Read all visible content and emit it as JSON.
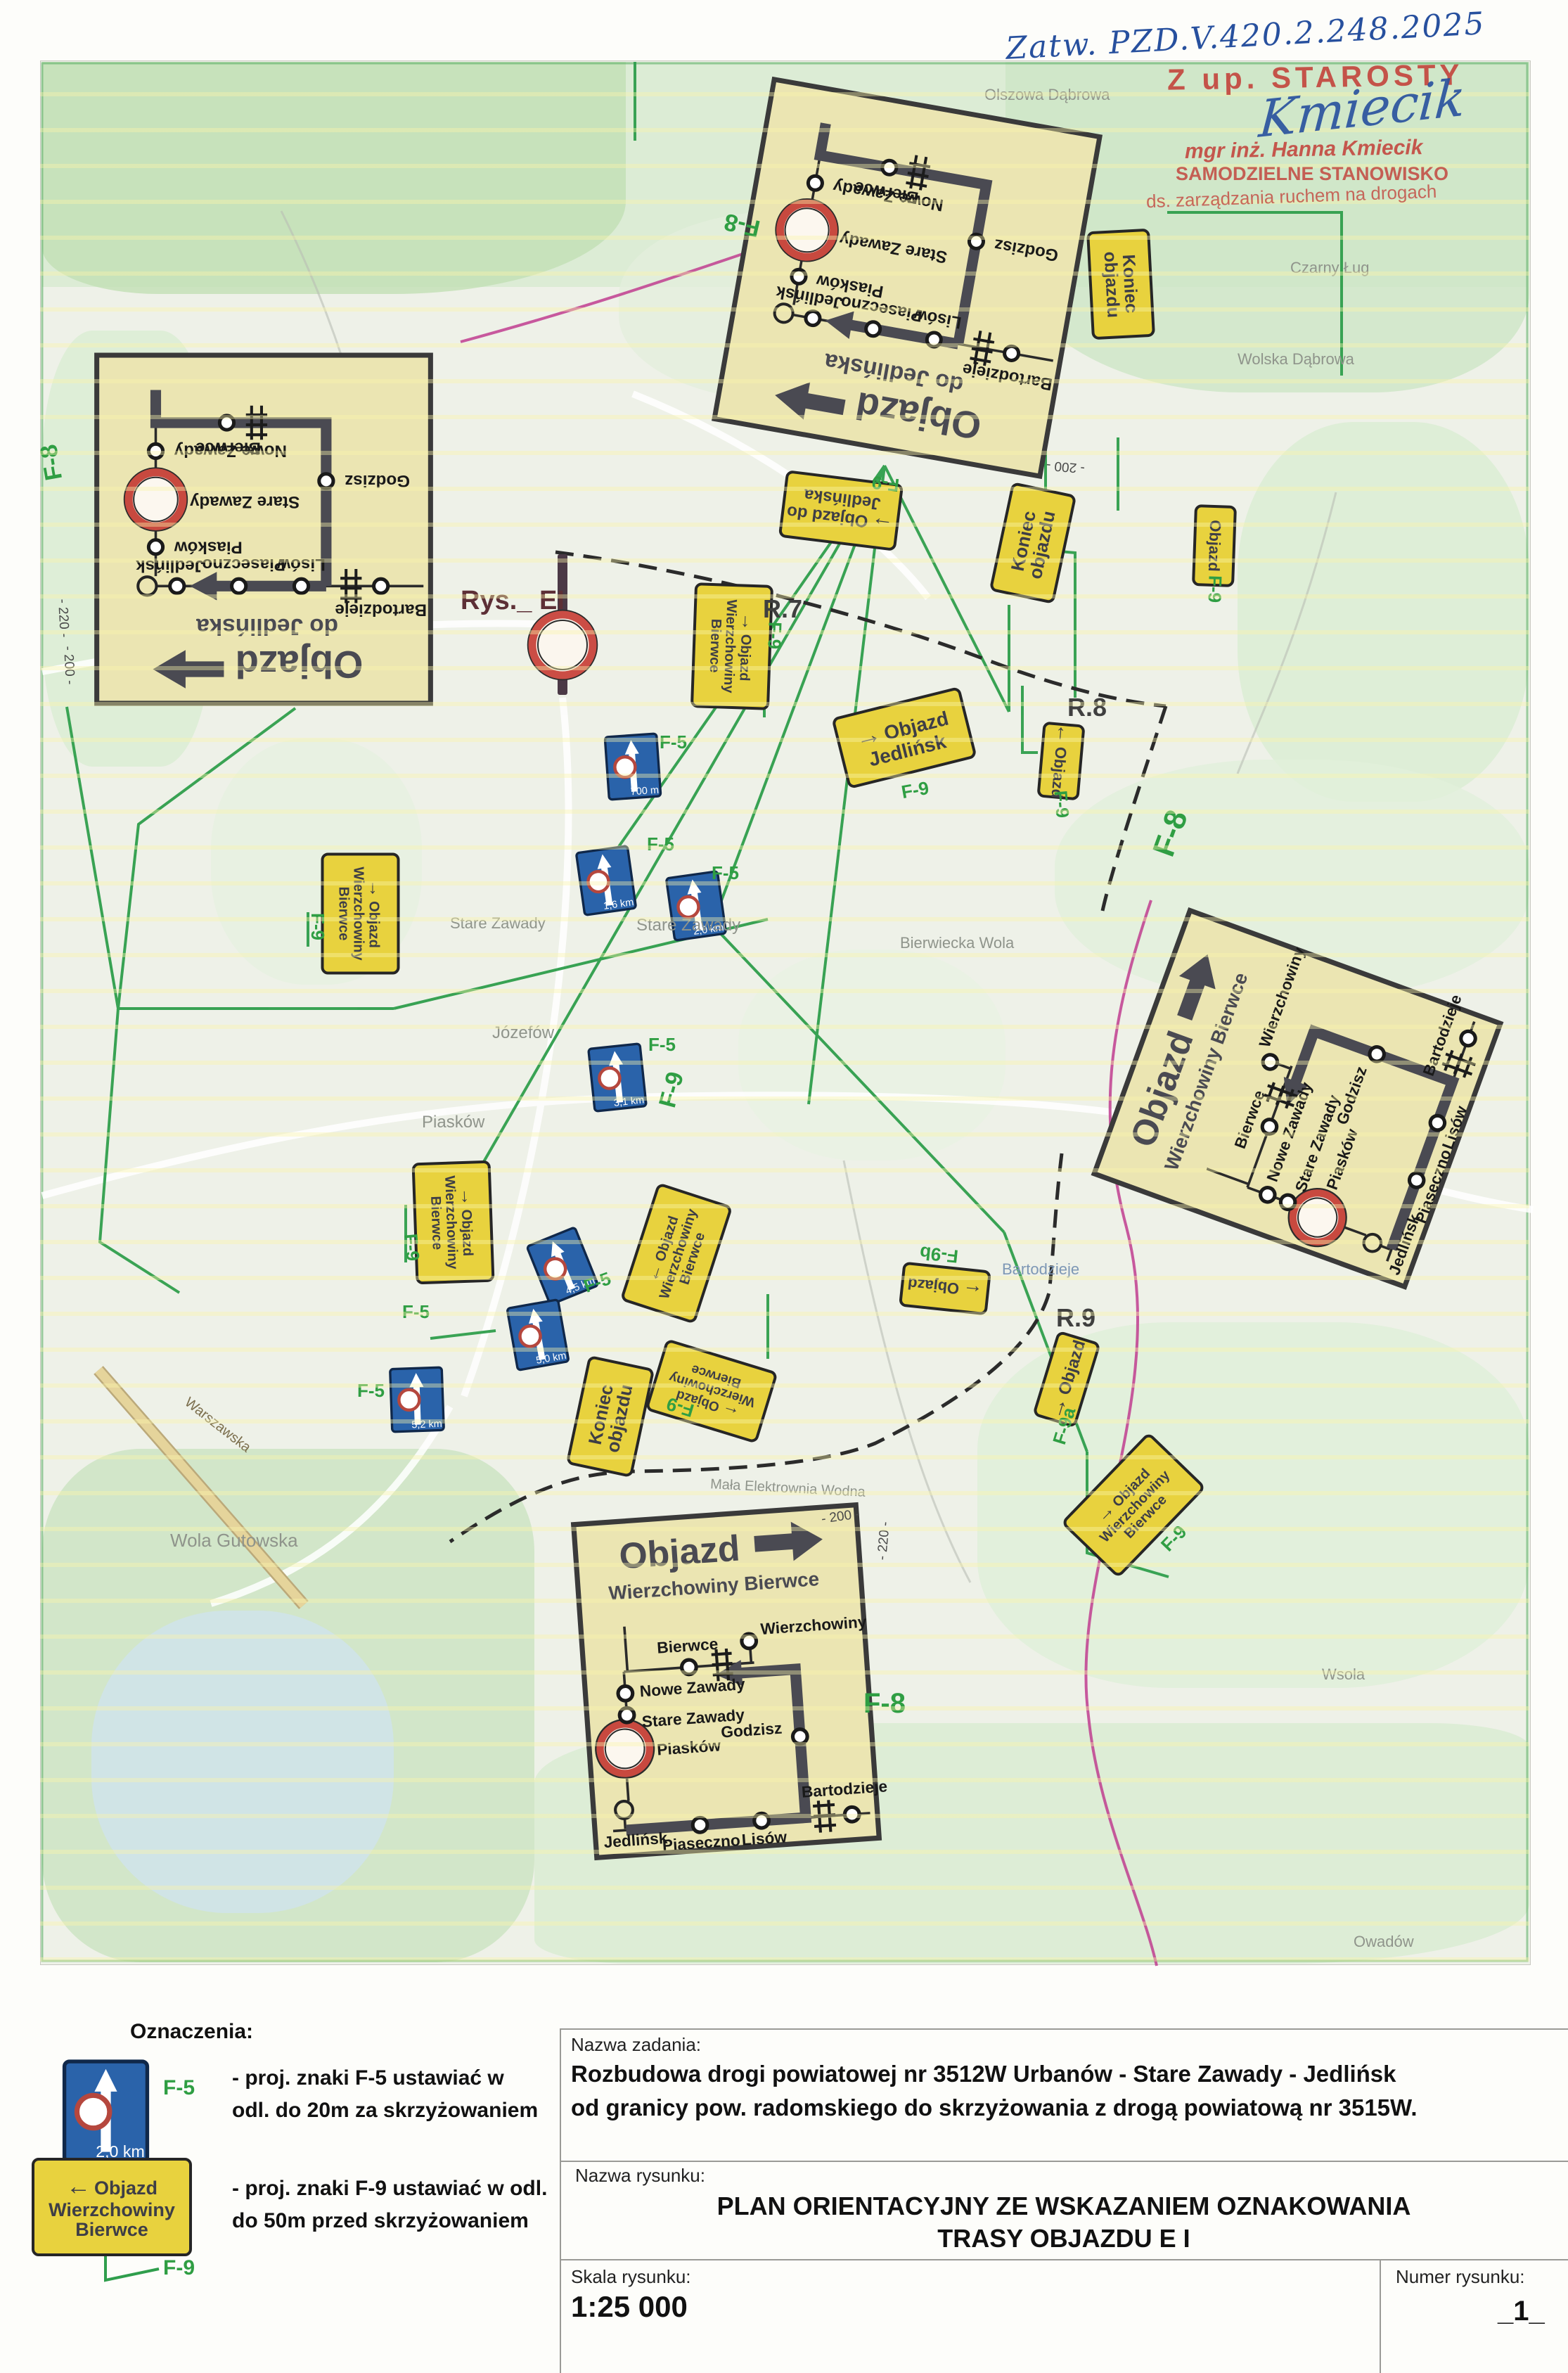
{
  "approval": {
    "handwritten_ref": "Zatw. PZD.V.420.2.248.2025",
    "stamp_title": "Z up. STAROSTY",
    "signature": "Kmiecik",
    "stamp_name": "mgr inż. Hanna Kmiecik",
    "stamp_role1": "SAMODZIELNE STANOWISKO",
    "stamp_role2": "ds. zarządzania ruchem na drogach"
  },
  "map": {
    "figure_label": "Rys._ EI",
    "refs": [
      "R.7",
      "R.8",
      "R.9"
    ],
    "green_labels": [
      "F-8",
      "F-8",
      "F-8",
      "F-8",
      "F-9"
    ],
    "contours": [
      "- 220 -",
      "- 200 -",
      "- 200 -",
      "- 220 -",
      "- 200 -"
    ],
    "places": [
      "Olszowa Dąbrowa",
      "Wolska Dąbrowa",
      "Czarny Ług",
      "Stare Zawady",
      "Stare Zawady",
      "Józefów",
      "Piasków",
      "Bierwiecka Wola",
      "Wola Gutowska",
      "Bartodzieje",
      "Mała Elektrownia Wodna",
      "Wsola",
      "Owadów",
      "Warszawska"
    ]
  },
  "insets": {
    "jedlinska": {
      "title": "Objazd",
      "subtitle": "do Jedlińska",
      "nodes": {
        "bierwce": "Bierwce",
        "nowe_zawady": "Nowe Zawady",
        "stare_zawady": "Stare Zawady",
        "godzisz": "Godzisz",
        "piaskow": "Piasków",
        "piaseczno": "Piaseczno",
        "lisow": "Lisów",
        "bartodzieje": "Bartodzieje",
        "jedlinsk": "Jedlińsk"
      }
    },
    "wierzchowiny": {
      "title": "Objazd",
      "subtitle": "Wierzchowiny Bierwce",
      "nodes": {
        "bierwce": "Bierwce",
        "wierzchowiny": "Wierzchowiny",
        "nowe_zawady": "Nowe Zawady",
        "stare_zawady": "Stare Zawady",
        "godzisz": "Godzisz",
        "piaskow": "Piasków",
        "piaseczno": "Piaseczno",
        "lisow": "Lisów",
        "bartodzieje": "Bartodzieje",
        "jedlinsk": "Jedlińsk"
      }
    }
  },
  "signs": {
    "yellow": [
      {
        "l1": "Objazd",
        "l2": "Wierzchowiny",
        "l3": "Bierwce",
        "arrow": "→",
        "tag": "F-9"
      },
      {
        "l1": "Objazd do",
        "l2": "Jedlińska",
        "l3": "",
        "arrow": "→",
        "tag": "F-9"
      },
      {
        "l1": "Koniec",
        "l2": "objazdu",
        "l3": "",
        "arrow": "",
        "tag": ""
      },
      {
        "l1": "Objazd",
        "l2": "Jedlińsk",
        "l3": "",
        "arrow": "→",
        "tag": "F-9"
      },
      {
        "l1": "Objazd",
        "l2": "",
        "l3": "",
        "arrow": "←",
        "tag": "F-9"
      },
      {
        "l1": "Objazd",
        "l2": "Wierzchowiny",
        "l3": "Bierwce",
        "arrow": "→",
        "tag": "F-9"
      },
      {
        "l1": "Objazd",
        "l2": "Wierzchowiny",
        "l3": "Bierwce",
        "arrow": "→",
        "tag": "F-9"
      },
      {
        "l1": "Objazd",
        "l2": "Wierzchowiny",
        "l3": "Bierwce",
        "arrow": "←",
        "tag": ""
      },
      {
        "l1": "Koniec",
        "l2": "objazdu",
        "l3": "",
        "arrow": "",
        "tag": ""
      },
      {
        "l1": "Objazd",
        "l2": "Wierzchowiny",
        "l3": "Bierwce",
        "arrow": "←",
        "tag": "F-9"
      },
      {
        "l1": "Objazd",
        "l2": "",
        "l3": "",
        "arrow": "→",
        "tag": "F-9a"
      },
      {
        "l1": "Objazd",
        "l2": "Wierzchowiny",
        "l3": "Bierwce",
        "arrow": "→",
        "tag": "F-9"
      },
      {
        "l1": "Koniec",
        "l2": "objazdu",
        "l3": "",
        "arrow": "",
        "tag": ""
      },
      {
        "l1": "Objazd",
        "l2": "",
        "l3": "",
        "arrow": "",
        "tag": "F-9"
      },
      {
        "l1": "Objazd",
        "l2": "",
        "l3": "",
        "arrow": "←",
        "tag": "F-9b"
      }
    ],
    "blue": [
      {
        "dist": "700 m",
        "tag": "F-5"
      },
      {
        "dist": "1,6 km",
        "tag": "F-5"
      },
      {
        "dist": "2,0 km",
        "tag": "F-5"
      },
      {
        "dist": "3,1 km",
        "tag": "F-5"
      },
      {
        "dist": "4,5 km",
        "tag": "F-5"
      },
      {
        "dist": "5,0 km",
        "tag": "F-5"
      },
      {
        "dist": "5,2 km",
        "tag": "F-5"
      }
    ]
  },
  "legend": {
    "heading": "Oznaczenia:",
    "f5": {
      "code": "F-5",
      "sign_dist": "2,0 km",
      "desc1": "- proj. znaki F-5 ustawiać w",
      "desc2": "odl. do 20m za skrzyżowaniem"
    },
    "f9": {
      "code": "F-9",
      "sign": {
        "arrow": "←",
        "l1": "Objazd",
        "l2": "Wierzchowiny",
        "l3": "Bierwce"
      },
      "desc1": "- proj. znaki F-9 ustawiać w odl.",
      "desc2": "do 50m przed skrzyżowaniem"
    }
  },
  "titleblock": {
    "task_label": "Nazwa zadania:",
    "task_line1": "Rozbudowa drogi powiatowej nr 3512W Urbanów - Stare Zawady - Jedlińsk",
    "task_line2": "od granicy pow. radomskiego do skrzyżowania z drogą powiatową nr 3515W.",
    "drawing_label": "Nazwa rysunku:",
    "drawing_line1": "PLAN ORIENTACYJNY ZE WSKAZANIEM OZNAKOWANIA",
    "drawing_line2": "TRASY OBJAZDU E I",
    "scale_label": "Skala rysunku:",
    "scale_value": "1:25 000",
    "number_label": "Numer rysunku:",
    "number_value": "_1_"
  }
}
